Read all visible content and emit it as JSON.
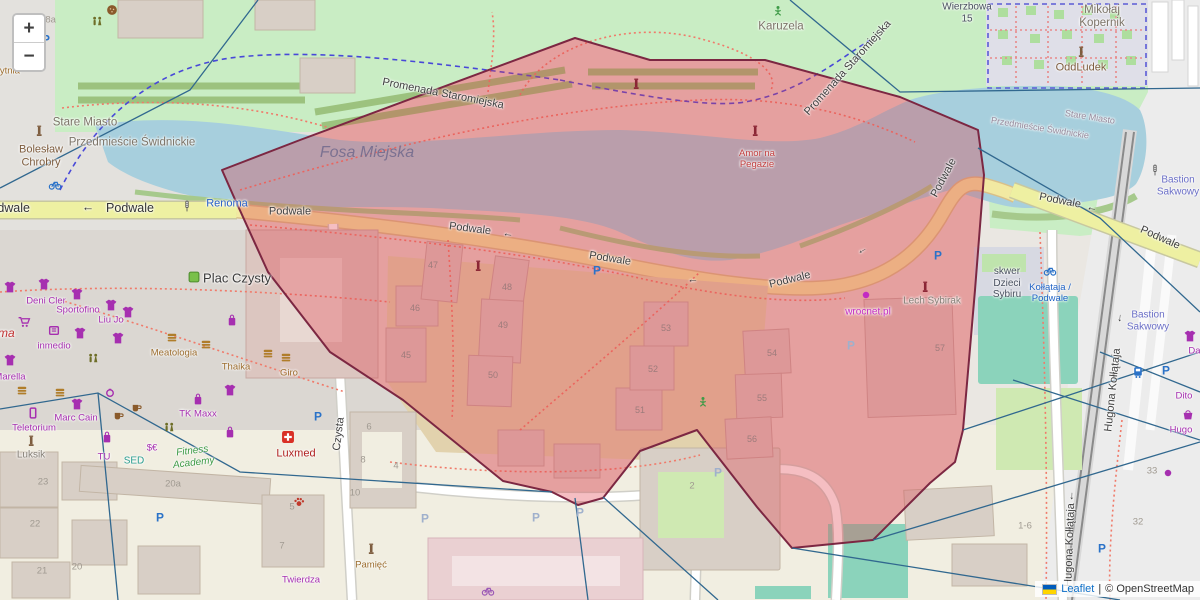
{
  "app": {
    "type": "leaflet-map",
    "region_shown": "Podwale / Fosa Miejska area"
  },
  "zoom_control": {
    "zoom_in": "+",
    "zoom_out": "−"
  },
  "attribution": {
    "flag": "ukraine-flag-icon",
    "leaflet_link": "Leaflet",
    "separator": "|",
    "osm_text": "© OpenStreetMap"
  },
  "colors": {
    "background": "#eae7e2",
    "park": "#c9edc4",
    "water": "#a7cfdd",
    "road_yellow": "#eef0a2",
    "building": "#d8cfc6",
    "building_in_overlay": "#dcc6c0",
    "pitch_teal": "#8bd3bb",
    "overlay_fill": "rgba(226,58,70,0.33)",
    "overlay_stroke": "#7c2742",
    "boundary_line": "#31688f",
    "footpath_dotted": "#f07a6a",
    "cycleway_dashed": "#4848d8"
  },
  "overlay": {
    "name": "highlighted-region-polygon",
    "fill": "rgba(226,58,70,0.33)",
    "stroke": "#7c2742",
    "stroke_width": 2,
    "points": "222,170 300,140 575,38 650,60 765,60 900,97 978,130 984,175 975,290 963,430 955,462 930,483 873,540 792,548 757,507 697,430 640,451 603,498 578,505 552,492 503,481 403,400 330,352 268,272 233,195"
  },
  "boundary_lines": {
    "color": "#31688f",
    "width": 1.3,
    "lines": [
      "258,0 190,90 0,188",
      "790,0 900,92 1200,88",
      "978,148 1100,218 1200,312",
      "963,430 1200,352",
      "1013,380 1200,440",
      "873,540 1200,442",
      "1100,352 1200,392",
      "792,548 1120,600",
      "603,497 718,600",
      "552,492 240,472 98,393 0,409",
      "98,393 118,600",
      "575,498 588,600"
    ]
  },
  "labels": [
    {
      "name": "street-label-podwale",
      "cls": "street-lg",
      "text": "Podwale",
      "x": 6,
      "y": 208
    },
    {
      "name": "arrow-left-icon",
      "cls": "street-lg",
      "text": "←",
      "x": 88,
      "y": 207
    },
    {
      "name": "street-label-podwale",
      "cls": "street-lg",
      "text": "Podwale",
      "x": 130,
      "y": 208
    },
    {
      "name": "street-label-podwale",
      "cls": "street",
      "text": "Podwale",
      "x": 290,
      "y": 212
    },
    {
      "name": "street-label-podwale",
      "cls": "street",
      "text": "Podwale",
      "x": 470,
      "y": 229,
      "rot": 7
    },
    {
      "name": "arrow-left-icon",
      "cls": "street",
      "text": "←",
      "x": 508,
      "y": 234,
      "rot": 7
    },
    {
      "name": "street-label-podwale",
      "cls": "street",
      "text": "Podwale",
      "x": 610,
      "y": 259,
      "rot": 9
    },
    {
      "name": "arrow-left-icon",
      "cls": "street",
      "text": "←",
      "x": 693,
      "y": 280
    },
    {
      "name": "street-label-podwale",
      "cls": "street",
      "text": "Podwale",
      "x": 790,
      "y": 280,
      "rot": -14
    },
    {
      "name": "arrow-left-icon",
      "cls": "street",
      "text": "←",
      "x": 862,
      "y": 250,
      "rot": -30
    },
    {
      "name": "street-label-podwale",
      "cls": "street",
      "text": "Podwale",
      "x": 944,
      "y": 178,
      "rot": -62
    },
    {
      "name": "street-label-podwale",
      "cls": "street",
      "text": "Podwale",
      "x": 1060,
      "y": 201,
      "rot": 11
    },
    {
      "name": "arrow-left-icon",
      "cls": "street",
      "text": "←",
      "x": 1092,
      "y": 208,
      "rot": 11
    },
    {
      "name": "street-label-podwale",
      "cls": "street",
      "text": "Podwale",
      "x": 1160,
      "y": 238,
      "rot": 24
    },
    {
      "name": "street-label-promenada",
      "cls": "street",
      "text": "Promenada Staromiejska",
      "x": 443,
      "y": 94,
      "rot": 11
    },
    {
      "name": "street-label-promenada",
      "cls": "street",
      "text": "Promenada Staromiejska",
      "x": 848,
      "y": 68,
      "rot": -48
    },
    {
      "name": "street-label-czysta",
      "cls": "street",
      "text": "Czysta",
      "x": 339,
      "y": 434,
      "rot": -83
    },
    {
      "name": "street-label-kollataja",
      "cls": "street",
      "text": "Hugona Kołłątaja",
      "x": 1070,
      "y": 545,
      "rot": -88
    },
    {
      "name": "arrow-left-icon",
      "cls": "street",
      "text": "←",
      "x": 1071,
      "y": 496,
      "rot": -88
    },
    {
      "name": "street-label-kollataja",
      "cls": "street",
      "text": "Hugona Kołłątaja",
      "x": 1113,
      "y": 390,
      "rot": -84
    },
    {
      "name": "arrow-left-icon",
      "cls": "street",
      "text": "←",
      "x": 1119,
      "y": 318,
      "rot": -84
    },
    {
      "name": "place-label-stare-miasto",
      "cls": "place",
      "text": "Stare Miasto",
      "x": 85,
      "y": 123
    },
    {
      "name": "place-label-przedmiescie",
      "cls": "place",
      "text": "Przedmieście Świdnickie",
      "x": 132,
      "y": 143
    },
    {
      "name": "place-label-stare-miasto",
      "cls": "place-sm",
      "text": "Stare Miasto",
      "x": 1090,
      "y": 117,
      "rot": 9
    },
    {
      "name": "place-label-przedmiescie",
      "cls": "place-sm",
      "text": "Przedmieście Świdnickie",
      "x": 1040,
      "y": 128,
      "rot": 9
    },
    {
      "name": "poi-label-boleslaw-chrobry",
      "cls": "place-brown",
      "text": "Bolesław\nChrobry",
      "x": 41,
      "y": 156
    },
    {
      "name": "place-label-karuzela",
      "cls": "place",
      "text": "Karuzela",
      "x": 781,
      "y": 27
    },
    {
      "name": "place-label-mikolaj-kopernik",
      "cls": "place",
      "text": "Mikołaj\nKopernik",
      "x": 1102,
      "y": 17
    },
    {
      "name": "poi-label-oddludek",
      "cls": "place-brown",
      "text": "OddLudek",
      "x": 1081,
      "y": 68
    },
    {
      "name": "place-label-wierzbowa",
      "cls": "place-dark",
      "text": "Wierzbowa\n15",
      "x": 967,
      "y": 13
    },
    {
      "name": "place-label-plac-czysty",
      "cls": "place-lg",
      "text": "Plac Czysty",
      "x": 237,
      "y": 279
    },
    {
      "name": "place-label-skwer-dzieci-sybiru",
      "cls": "place-dark",
      "text": "skwer\nDzieci\nSybiru",
      "x": 1007,
      "y": 283
    },
    {
      "name": "water-label-fosa-miejska",
      "cls": "water",
      "text": "Fosa Miejska",
      "x": 367,
      "y": 153
    },
    {
      "name": "place-label-bastion-sakwowy",
      "cls": "bastion",
      "text": "Bastion\nSakwowy",
      "x": 1178,
      "y": 186
    },
    {
      "name": "place-label-bastion-sakwowy",
      "cls": "bastion",
      "text": "Bastion\nSakwowy",
      "x": 1148,
      "y": 321
    },
    {
      "name": "place-label-gobytnia",
      "cls": "poi-brown",
      "text": "gobytnia",
      "x": 2,
      "y": 72
    },
    {
      "name": "transit-label-renoma",
      "cls": "poi-blue",
      "text": "Renoma",
      "x": 227,
      "y": 204
    },
    {
      "name": "poi-label-renoma-mall",
      "cls": "poi-red-italic",
      "text": "Renoma",
      "x": -8,
      "y": 334
    },
    {
      "name": "poi-label-amor-na-pegazie",
      "cls": "poi-red",
      "text": "Amor na\nPegazie",
      "x": 757,
      "y": 160
    },
    {
      "name": "poi-label-wrocnet",
      "cls": "poi-magenta",
      "text": "wrocnet.pl",
      "x": 868,
      "y": 312
    },
    {
      "name": "poi-label-lech-sybirak",
      "cls": "poi-gray",
      "text": "Lech Sybirak",
      "x": 932,
      "y": 301
    },
    {
      "name": "poi-label-luxmed",
      "cls": "poi-darkred",
      "text": "Luxmed",
      "x": 296,
      "y": 454
    },
    {
      "name": "poi-label-fitness-academy",
      "cls": "poi-green",
      "text": "Fitness\nAcademy",
      "x": 193,
      "y": 457,
      "rot": -7
    },
    {
      "name": "poi-label-tk-maxx",
      "cls": "poi-purple",
      "text": "TK Maxx",
      "x": 198,
      "y": 415
    },
    {
      "name": "poi-label-marc-cain",
      "cls": "poi-purple",
      "text": "Marc Cain",
      "x": 76,
      "y": 419
    },
    {
      "name": "poi-label-teletorium",
      "cls": "poi-purple",
      "text": "Teletorium",
      "x": 34,
      "y": 429
    },
    {
      "name": "poi-label-luksik",
      "cls": "poi-gray",
      "text": "Luksik",
      "x": 31,
      "y": 455
    },
    {
      "name": "poi-label-tu",
      "cls": "poi-purple",
      "text": "TU",
      "x": 104,
      "y": 458
    },
    {
      "name": "poi-label-sed",
      "cls": "poi-teal",
      "text": "SED",
      "x": 134,
      "y": 461
    },
    {
      "name": "poi-label-meatologia",
      "cls": "poi-brown",
      "text": "Meatologia",
      "x": 174,
      "y": 354
    },
    {
      "name": "poi-label-thaika",
      "cls": "poi-brown",
      "text": "Thaika",
      "x": 236,
      "y": 368
    },
    {
      "name": "poi-label-giro",
      "cls": "poi-brown",
      "text": "Giro",
      "x": 289,
      "y": 374
    },
    {
      "name": "poi-label-deni-cler",
      "cls": "poi-purple",
      "text": "Deni Cler",
      "x": 46,
      "y": 302
    },
    {
      "name": "poi-label-sportofino",
      "cls": "poi-purple",
      "text": "Sportofino",
      "x": 78,
      "y": 311
    },
    {
      "name": "poi-label-liu-jo",
      "cls": "poi-purple",
      "text": "Liu Jo",
      "x": 111,
      "y": 321
    },
    {
      "name": "poi-label-inmedio",
      "cls": "poi-purple",
      "text": "inmedio",
      "x": 54,
      "y": 347
    },
    {
      "name": "poi-label-marella",
      "cls": "poi-purple",
      "text": "Marella",
      "x": 10,
      "y": 378
    },
    {
      "name": "poi-label-twierdza",
      "cls": "poi-purple",
      "text": "Twierdza",
      "x": 301,
      "y": 581
    },
    {
      "name": "poi-label-pamiec",
      "cls": "poi-brown",
      "text": "Pamięć",
      "x": 371,
      "y": 566
    },
    {
      "name": "poi-label-dito",
      "cls": "poi-purple",
      "text": "Dito",
      "x": 1184,
      "y": 397
    },
    {
      "name": "poi-label-hugo",
      "cls": "poi-purple",
      "text": "Hugo",
      "x": 1181,
      "y": 431
    },
    {
      "name": "poi-label-dar",
      "cls": "poi-purple",
      "text": "Dar",
      "x": 1196,
      "y": 352
    },
    {
      "name": "transit-label-kollataja-podwale",
      "cls": "transit",
      "text": "Kołłątaja /\nPodwale",
      "x": 1050,
      "y": 294
    },
    {
      "name": "poi-label-currency",
      "cls": "poi-purple",
      "text": "$€",
      "x": 152,
      "y": 449
    },
    {
      "name": "house-number",
      "cls": "num",
      "text": "45",
      "x": 406,
      "y": 355
    },
    {
      "name": "house-number",
      "cls": "num",
      "text": "46",
      "x": 415,
      "y": 308
    },
    {
      "name": "house-number",
      "cls": "num",
      "text": "47",
      "x": 433,
      "y": 265
    },
    {
      "name": "house-number",
      "cls": "num",
      "text": "48",
      "x": 507,
      "y": 287
    },
    {
      "name": "house-number",
      "cls": "num",
      "text": "49",
      "x": 503,
      "y": 325
    },
    {
      "name": "house-number",
      "cls": "num",
      "text": "50",
      "x": 493,
      "y": 375
    },
    {
      "name": "house-number",
      "cls": "num",
      "text": "51",
      "x": 640,
      "y": 410
    },
    {
      "name": "house-number",
      "cls": "num",
      "text": "52",
      "x": 653,
      "y": 369
    },
    {
      "name": "house-number",
      "cls": "num",
      "text": "53",
      "x": 666,
      "y": 328
    },
    {
      "name": "house-number",
      "cls": "num",
      "text": "54",
      "x": 772,
      "y": 353
    },
    {
      "name": "house-number",
      "cls": "num",
      "text": "55",
      "x": 762,
      "y": 398
    },
    {
      "name": "house-number",
      "cls": "num",
      "text": "56",
      "x": 752,
      "y": 439
    },
    {
      "name": "house-number",
      "cls": "num",
      "text": "57",
      "x": 940,
      "y": 348
    },
    {
      "name": "house-number",
      "cls": "num-gray",
      "text": "38a",
      "x": 48,
      "y": 21
    },
    {
      "name": "house-number",
      "cls": "num-gray",
      "text": "23",
      "x": 43,
      "y": 483
    },
    {
      "name": "house-number",
      "cls": "num-gray",
      "text": "22",
      "x": 35,
      "y": 525
    },
    {
      "name": "house-number",
      "cls": "num-gray",
      "text": "21",
      "x": 42,
      "y": 572
    },
    {
      "name": "house-number",
      "cls": "num-gray",
      "text": "20",
      "x": 77,
      "y": 568
    },
    {
      "name": "house-number",
      "cls": "num-gray",
      "text": "20a",
      "x": 173,
      "y": 485
    },
    {
      "name": "house-number",
      "cls": "num-gray",
      "text": "5",
      "x": 292,
      "y": 508
    },
    {
      "name": "house-number",
      "cls": "num-gray",
      "text": "7",
      "x": 282,
      "y": 547
    },
    {
      "name": "house-number",
      "cls": "num-gray",
      "text": "6",
      "x": 369,
      "y": 428
    },
    {
      "name": "house-number",
      "cls": "num-gray",
      "text": "8",
      "x": 363,
      "y": 461
    },
    {
      "name": "house-number",
      "cls": "num-gray",
      "text": "10",
      "x": 355,
      "y": 494
    },
    {
      "name": "house-number",
      "cls": "num-gray",
      "text": "4",
      "x": 396,
      "y": 467
    },
    {
      "name": "house-number",
      "cls": "num-gray",
      "text": "2",
      "x": 692,
      "y": 487
    },
    {
      "name": "house-number",
      "cls": "num-gray",
      "text": "1-6",
      "x": 1025,
      "y": 527
    },
    {
      "name": "house-number",
      "cls": "num-gray",
      "text": "33",
      "x": 1152,
      "y": 472
    },
    {
      "name": "house-number",
      "cls": "num-gray",
      "text": "32",
      "x": 1138,
      "y": 523
    }
  ],
  "icons": [
    {
      "type": "parking",
      "x": 46,
      "y": 39,
      "color": "#2a72c8"
    },
    {
      "type": "parking",
      "x": 597,
      "y": 270,
      "color": "#2a72c8"
    },
    {
      "type": "parking",
      "x": 938,
      "y": 255,
      "color": "#2a72c8"
    },
    {
      "type": "parking",
      "x": 1166,
      "y": 370,
      "color": "#2a72c8"
    },
    {
      "type": "parking",
      "x": 1102,
      "y": 548,
      "color": "#2a72c8"
    },
    {
      "type": "parking",
      "x": 160,
      "y": 517,
      "color": "#2a72c8"
    },
    {
      "type": "parking",
      "x": 318,
      "y": 416,
      "color": "#2a72c8"
    },
    {
      "type": "parking",
      "x": 425,
      "y": 518,
      "color": "#9fb0cc"
    },
    {
      "type": "parking",
      "x": 536,
      "y": 517,
      "color": "#9fb0cc"
    },
    {
      "type": "parking",
      "x": 580,
      "y": 512,
      "color": "#9fb0cc"
    },
    {
      "type": "parking",
      "x": 851,
      "y": 345,
      "color": "#9fb0cc"
    },
    {
      "type": "parking",
      "x": 718,
      "y": 472,
      "color": "#9fb0cc"
    },
    {
      "type": "bike",
      "x": 55,
      "y": 184,
      "color": "#2a72c8"
    },
    {
      "type": "bike",
      "x": 1050,
      "y": 270,
      "color": "#2a72c8"
    },
    {
      "type": "bike",
      "x": 488,
      "y": 590,
      "color": "#9b59b6"
    },
    {
      "type": "tram",
      "x": 1138,
      "y": 372,
      "color": "#2a72c8"
    },
    {
      "type": "tshirt",
      "x": 10,
      "y": 287,
      "color": "#a62fb0"
    },
    {
      "type": "tshirt",
      "x": 44,
      "y": 284,
      "color": "#a62fb0"
    },
    {
      "type": "tshirt",
      "x": 77,
      "y": 294,
      "color": "#a62fb0"
    },
    {
      "type": "tshirt",
      "x": 111,
      "y": 305,
      "color": "#a62fb0"
    },
    {
      "type": "tshirt",
      "x": 128,
      "y": 312,
      "color": "#a62fb0"
    },
    {
      "type": "tshirt",
      "x": 80,
      "y": 333,
      "color": "#a62fb0"
    },
    {
      "type": "tshirt",
      "x": 118,
      "y": 338,
      "color": "#a62fb0"
    },
    {
      "type": "tshirt",
      "x": 10,
      "y": 360,
      "color": "#a62fb0"
    },
    {
      "type": "tshirt",
      "x": 230,
      "y": 390,
      "color": "#a62fb0"
    },
    {
      "type": "tshirt",
      "x": 77,
      "y": 404,
      "color": "#a62fb0"
    },
    {
      "type": "tshirt",
      "x": 1190,
      "y": 336,
      "color": "#a62fb0"
    },
    {
      "type": "bag",
      "x": 198,
      "y": 399,
      "color": "#a62fb0"
    },
    {
      "type": "bag",
      "x": 232,
      "y": 320,
      "color": "#a62fb0"
    },
    {
      "type": "bag",
      "x": 230,
      "y": 432,
      "color": "#a62fb0"
    },
    {
      "type": "bag",
      "x": 107,
      "y": 437,
      "color": "#a62fb0"
    },
    {
      "type": "basket",
      "x": 1188,
      "y": 414,
      "color": "#a62fb0"
    },
    {
      "type": "phone",
      "x": 33,
      "y": 413,
      "color": "#a62fb0"
    },
    {
      "type": "cart",
      "x": 24,
      "y": 322,
      "color": "#a62fb0"
    },
    {
      "type": "kiosk",
      "x": 54,
      "y": 330,
      "color": "#a62fb0"
    },
    {
      "type": "ring",
      "x": 110,
      "y": 392,
      "color": "#a62fb0"
    },
    {
      "type": "burger",
      "x": 172,
      "y": 337,
      "color": "#b07d2a"
    },
    {
      "type": "burger",
      "x": 206,
      "y": 344,
      "color": "#b07d2a"
    },
    {
      "type": "burger",
      "x": 22,
      "y": 390,
      "color": "#b07d2a"
    },
    {
      "type": "burger",
      "x": 60,
      "y": 392,
      "color": "#b07d2a"
    },
    {
      "type": "burger",
      "x": 268,
      "y": 353,
      "color": "#b07d2a"
    },
    {
      "type": "burger",
      "x": 286,
      "y": 357,
      "color": "#b07d2a"
    },
    {
      "type": "cup",
      "x": 118,
      "y": 415,
      "color": "#8a5a2b"
    },
    {
      "type": "cup",
      "x": 136,
      "y": 407,
      "color": "#8a5a2b"
    },
    {
      "type": "cafe",
      "x": 112,
      "y": 10,
      "color": "#8a5a2b"
    },
    {
      "type": "monument",
      "x": 39,
      "y": 131,
      "color": "#7e5d3f"
    },
    {
      "type": "monument",
      "x": 31,
      "y": 441,
      "color": "#7e5d3f"
    },
    {
      "type": "monument",
      "x": 371,
      "y": 549,
      "color": "#7e5d3f"
    },
    {
      "type": "monument",
      "x": 478,
      "y": 266,
      "color": "#8b2635"
    },
    {
      "type": "monument",
      "x": 925,
      "y": 287,
      "color": "#8b2635"
    },
    {
      "type": "monument",
      "x": 1081,
      "y": 52,
      "color": "#7e5d3f"
    },
    {
      "type": "monument",
      "x": 636,
      "y": 84,
      "color": "#8b2635"
    },
    {
      "type": "monument",
      "x": 755,
      "y": 131,
      "color": "#8b2635"
    },
    {
      "type": "wc",
      "x": 97,
      "y": 22,
      "color": "#6e6e28"
    },
    {
      "type": "wc",
      "x": 93,
      "y": 359,
      "color": "#6e6e28"
    },
    {
      "type": "wc",
      "x": 169,
      "y": 428,
      "color": "#6e6e28"
    },
    {
      "type": "firstaid",
      "x": 288,
      "y": 437,
      "color": "#d93025"
    },
    {
      "type": "paw",
      "x": 299,
      "y": 502,
      "color": "#c0392b"
    },
    {
      "type": "dot",
      "x": 866,
      "y": 295,
      "color": "#c32bc3"
    },
    {
      "type": "dot",
      "x": 1168,
      "y": 473,
      "color": "#a62fb0"
    },
    {
      "type": "playground",
      "x": 778,
      "y": 11,
      "color": "#3d9a46"
    },
    {
      "type": "playground",
      "x": 703,
      "y": 402,
      "color": "#3d9a46"
    },
    {
      "type": "signal",
      "x": 187,
      "y": 206,
      "color": "#555555"
    },
    {
      "type": "signal",
      "x": 1155,
      "y": 170,
      "color": "#555555"
    },
    {
      "type": "greensquare",
      "x": 194,
      "y": 277,
      "color": "#79c04a"
    }
  ]
}
